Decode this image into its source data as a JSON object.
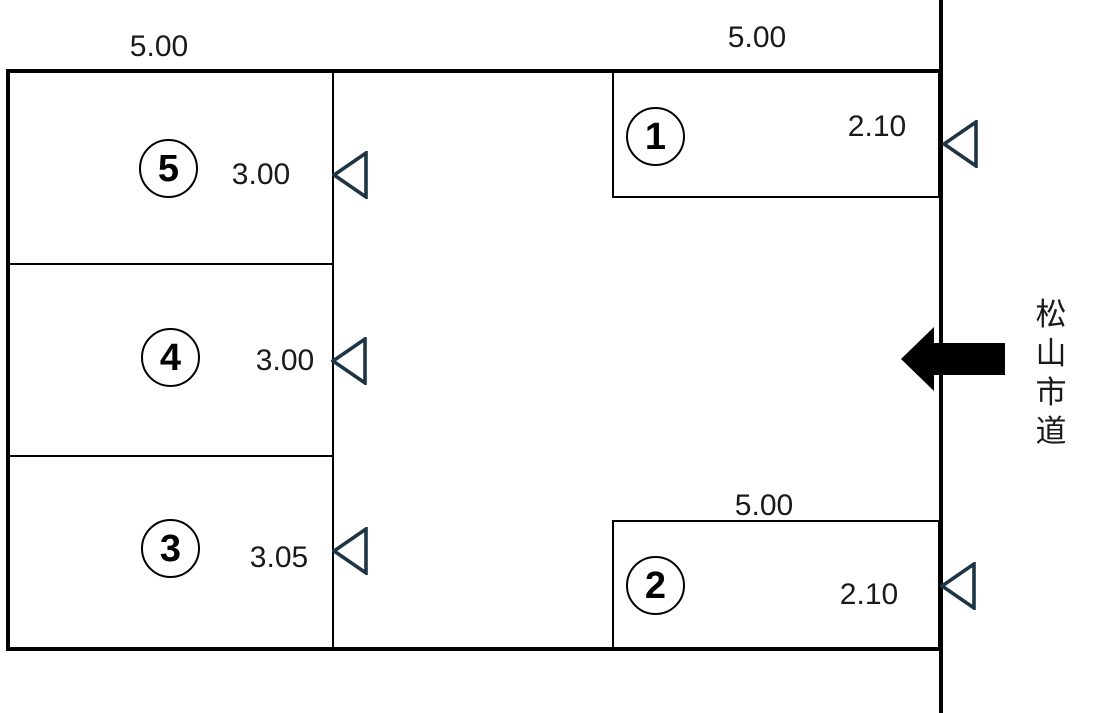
{
  "diagram": {
    "type": "parking-lot-layout",
    "road": {
      "label": "松山市道",
      "chars": [
        "松",
        "山",
        "市",
        "道"
      ]
    },
    "dimensions": {
      "left_block_width": "5.00"
    },
    "spaces": {
      "s1": {
        "number": "1",
        "width": "5.00",
        "depth": "2.10"
      },
      "s2": {
        "number": "2",
        "width": "5.00",
        "depth": "2.10"
      },
      "s3": {
        "number": "3",
        "depth": "3.05"
      },
      "s4": {
        "number": "4",
        "depth": "3.00"
      },
      "s5": {
        "number": "5",
        "depth": "3.00"
      }
    },
    "colors": {
      "line": "#000000",
      "text": "#1a1a1a",
      "entry_marker": "#1d3545",
      "background": "#ffffff"
    }
  }
}
